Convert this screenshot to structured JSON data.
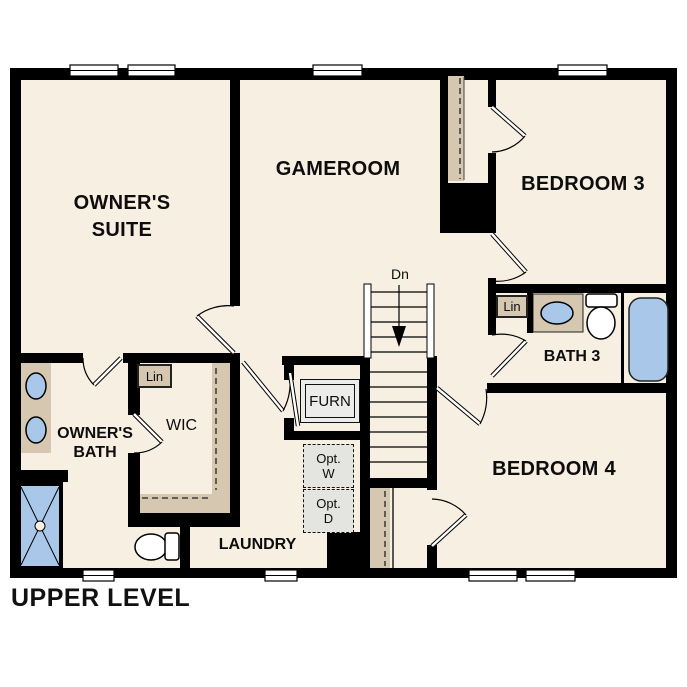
{
  "title": "UPPER LEVEL",
  "rooms": {
    "owners_suite_line1": "OWNER'S",
    "owners_suite_line2": "SUITE",
    "gameroom": "GAMEROOM",
    "bedroom3": "BEDROOM 3",
    "bedroom4": "BEDROOM 4",
    "bath3": "BATH 3",
    "owners_bath_line1": "OWNER'S",
    "owners_bath_line2": "BATH",
    "wic": "WIC",
    "laundry": "LAUNDRY"
  },
  "annotations": {
    "furnace": "FURN",
    "linen_wic": "Lin",
    "linen_bath3": "Lin",
    "stair_direction": "Dn",
    "opt_washer_line1": "Opt.",
    "opt_washer_line2": "W",
    "opt_dryer_line1": "Opt.",
    "opt_dryer_line2": "D"
  },
  "legend_colors": {
    "floor": "#F7EFE2",
    "walls": "#000000",
    "casework_tan": "#D5C7B0",
    "plumbing_fixture_blue": "#A9C7E9",
    "optional_appliance_gray": "#E4E4E1"
  }
}
